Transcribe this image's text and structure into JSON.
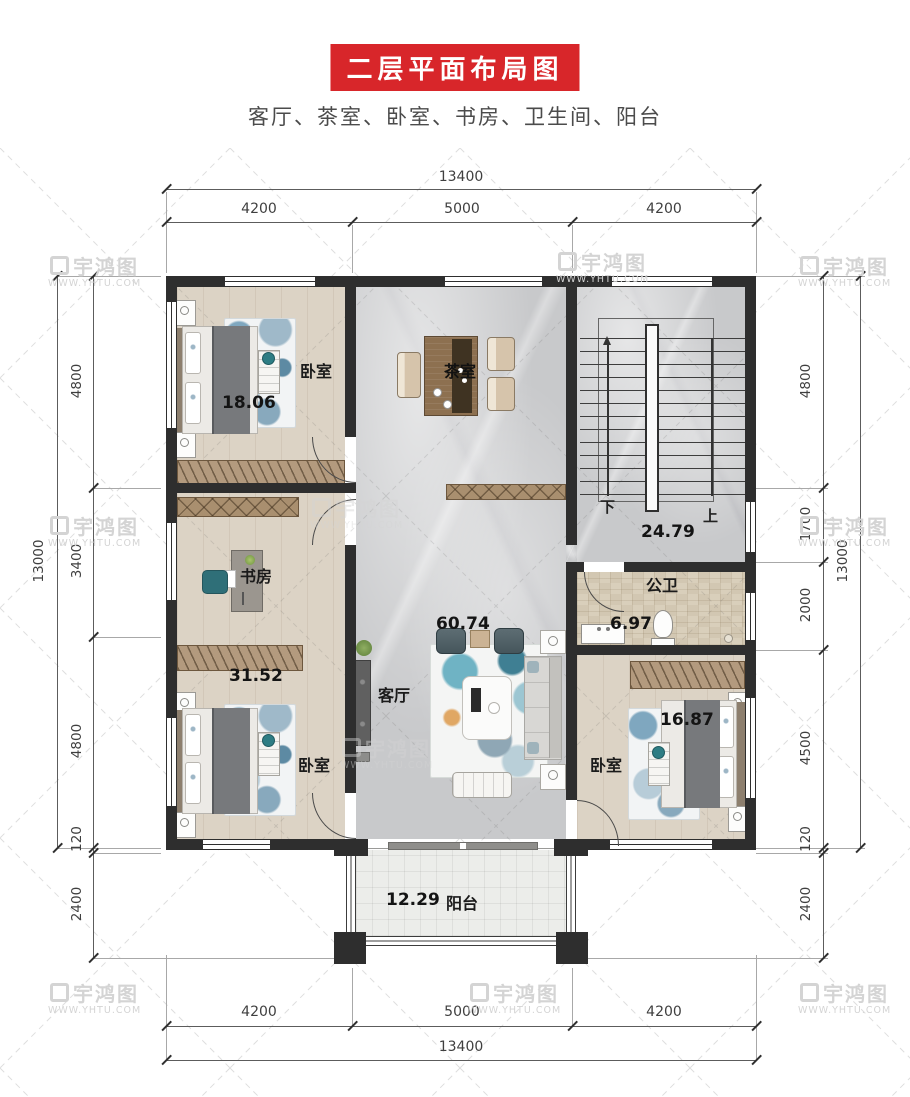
{
  "title": "二层平面布局图",
  "subtitle": "客厅、茶室、卧室、书房、卫生间、阳台",
  "watermark": {
    "brand": "宇鸿图",
    "site": "WWW.YHTU.COM"
  },
  "colors": {
    "banner_red": "#d8262a",
    "wall": "#2e2e2e",
    "wood_floor": "#dcd3c5",
    "marble_floor": "#c8c9cb",
    "tile_floor": "#d9cfbb",
    "teal_accent": "#2e7d84"
  },
  "dimensions": {
    "top": {
      "overall": "13400",
      "segments": [
        "4200",
        "5000",
        "4200"
      ]
    },
    "bottom": {
      "overall": "13400",
      "segments": [
        "4200",
        "5000",
        "4200"
      ]
    },
    "left": {
      "overall": "13000",
      "segments": [
        "4800",
        "3400",
        "4800",
        "120",
        "2400"
      ]
    },
    "right": {
      "overall": "13000",
      "segments": [
        "4800",
        "1700",
        "2000",
        "4500",
        "120",
        "2400"
      ]
    }
  },
  "rooms": {
    "bedroom_top_left": {
      "label": "卧室",
      "area": "18.06"
    },
    "tea_room": {
      "label": "茶室"
    },
    "stairwell": {
      "area": "24.79",
      "down_label": "下",
      "up_label": "上"
    },
    "study": {
      "label": "书房",
      "area": "31.52"
    },
    "living_room": {
      "label": "客厅",
      "area": "60.74"
    },
    "bathroom": {
      "label": "公卫",
      "area": "6.97"
    },
    "bedroom_bottom_left": {
      "label": "卧室"
    },
    "bedroom_bottom_right": {
      "label": "卧室",
      "area": "16.87"
    },
    "balcony": {
      "label": "阳台",
      "area": "12.29"
    }
  }
}
